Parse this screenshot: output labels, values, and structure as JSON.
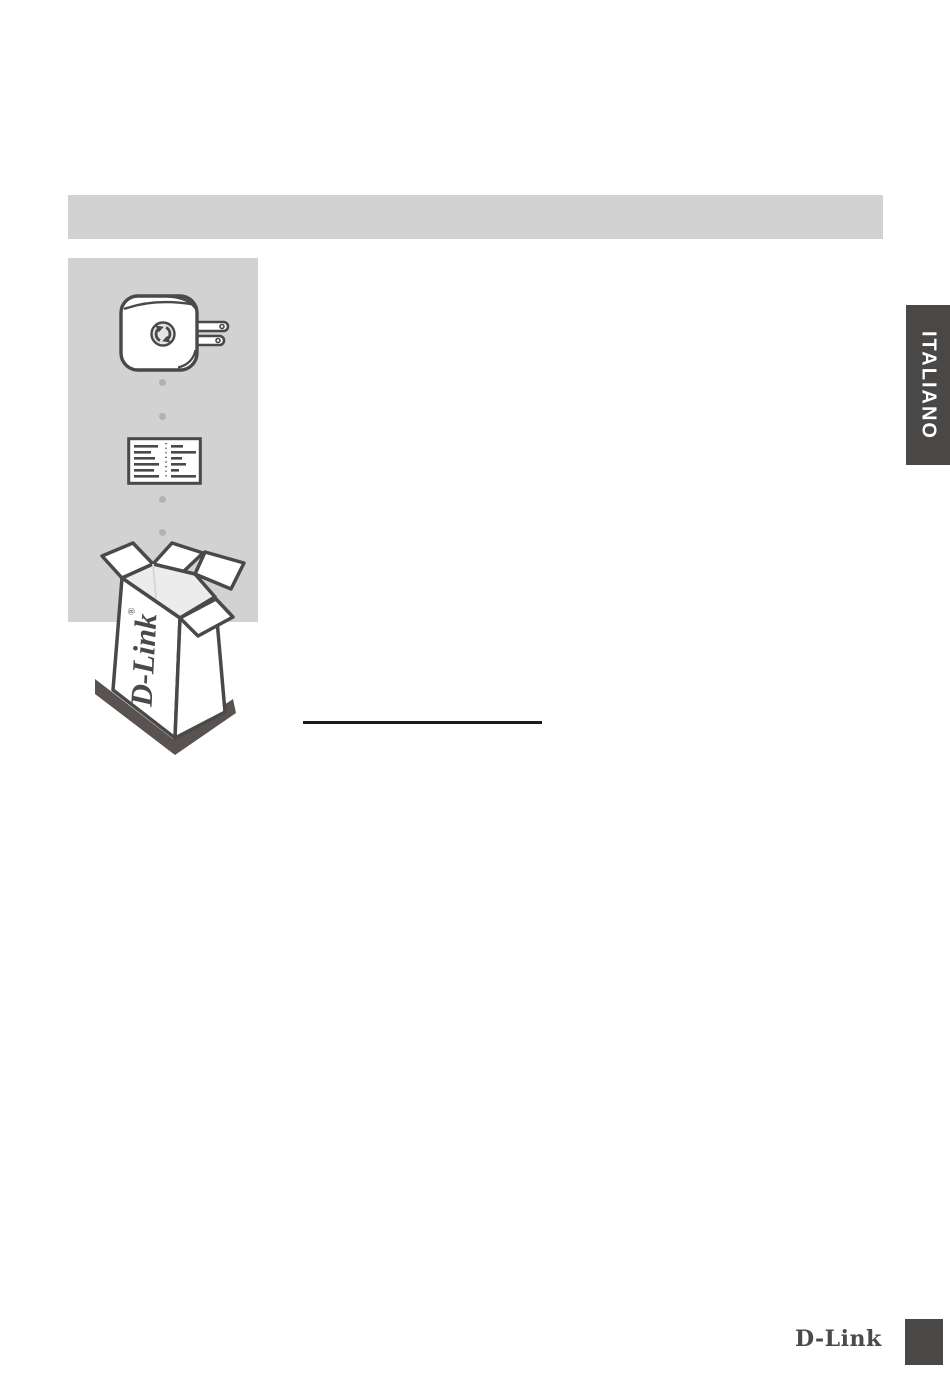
{
  "language_tab": {
    "label": "ITALIANO"
  },
  "box_illustration": {
    "brand": "D-Link",
    "registered": "®"
  },
  "footer": {
    "brand_logo": "D-Link"
  },
  "colors": {
    "page_bg": "#ffffff",
    "header_bar_bg": "#d2d2d2",
    "panel_bg": "#d2d2d2",
    "tab_bg": "#4a4747",
    "tab_text": "#ffffff",
    "illustration_stroke": "#4a4848",
    "illustration_fill": "#ffffff",
    "box_interior": "#ececec",
    "box_shadow": "#5a5250",
    "dot_gray": "#b2b2b2",
    "underline": "#1a1a1a",
    "footer_logo": "#4d4949",
    "footer_square": "#4a4747"
  },
  "icons": {
    "wps_icon": "two-curved-arrows-circle",
    "device_icon": "wall-plug-wifi-extender",
    "card_icon": "configuration-card",
    "box_icon": "open-product-box"
  }
}
